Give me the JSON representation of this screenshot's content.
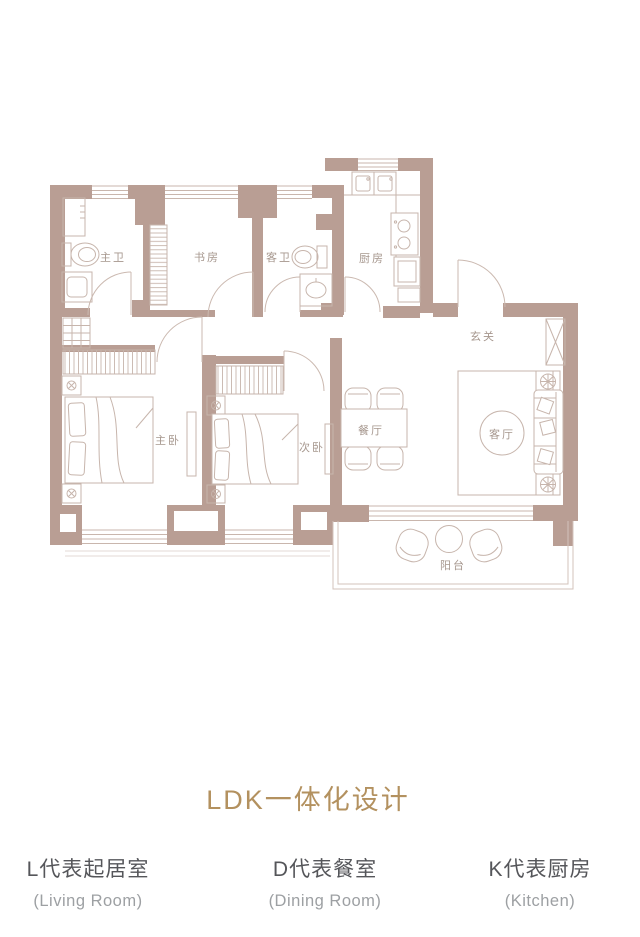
{
  "title": {
    "text": "LDK一体化设计"
  },
  "legend": {
    "items": [
      {
        "cn": "L代表起居室",
        "en": "(Living Room)"
      },
      {
        "cn": "D代表餐室",
        "en": "(Dining Room)"
      },
      {
        "cn": "K代表厨房",
        "en": "(Kitchen)"
      }
    ]
  },
  "floor_plan": {
    "rooms": [
      {
        "id": "master-bath",
        "label": "主卫"
      },
      {
        "id": "study",
        "label": "书房"
      },
      {
        "id": "guest-bath",
        "label": "客卫"
      },
      {
        "id": "kitchen",
        "label": "厨房"
      },
      {
        "id": "foyer",
        "label": "玄关"
      },
      {
        "id": "master-bedroom",
        "label": "主卧"
      },
      {
        "id": "second-bedroom",
        "label": "次卧"
      },
      {
        "id": "dining-room",
        "label": "餐厅"
      },
      {
        "id": "living-room",
        "label": "客厅"
      },
      {
        "id": "balcony",
        "label": "阳台"
      }
    ]
  },
  "palette": {
    "wall": "#b99e94",
    "furniture_line": "#c7b5ac",
    "light_line": "#ddd0ca",
    "room_label": "#a6978e",
    "title_gold": "#b3915f",
    "legend_cn": "#55565a",
    "legend_en": "#9da0a3"
  }
}
